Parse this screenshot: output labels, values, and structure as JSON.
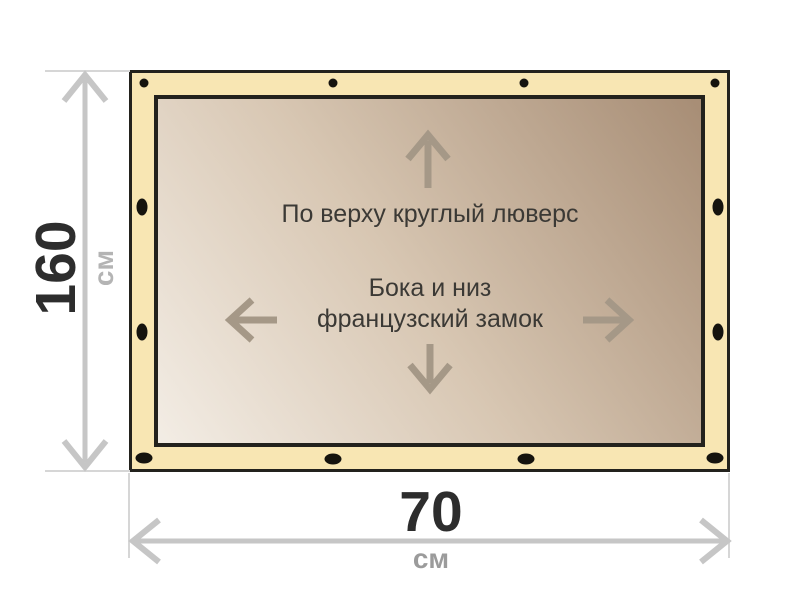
{
  "labels": {
    "height": {
      "value": "160",
      "unit": "см"
    },
    "width": {
      "value": "70",
      "unit": "см"
    },
    "top_note": "По верху круглый люверс",
    "middle_note_line1": "Бока и низ",
    "middle_note_line2": "французский замок"
  },
  "icons": {
    "inner_arrows": [
      "arrow-up-icon",
      "arrow-left-icon",
      "arrow-right-icon",
      "arrow-down-icon"
    ],
    "grommet_count": 12
  },
  "colors": {
    "banner_band": "#f8e6b3",
    "banner_border": "#23221d",
    "canvas_gradient_light": "#f3ede5",
    "canvas_gradient_dark": "#a78d75",
    "grommet": "#15130e",
    "dimension_line": "#c6c6c6",
    "extension_line": "#d6d6d6",
    "inner_arrow": "#a59887",
    "note_text": "#3b3935",
    "value_text": "#2d2d2d",
    "unit_text_left": "#b4b4b4",
    "unit_text_bottom": "#9b9b9b"
  }
}
